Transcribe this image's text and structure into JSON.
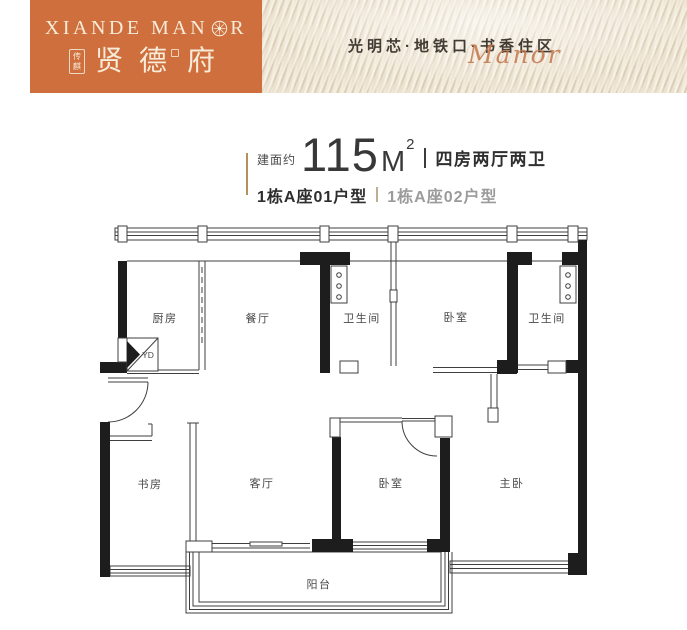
{
  "colors": {
    "brand_orange": "#d06f3e",
    "cream_text": "#f6ecd9",
    "gold_accent": "#b5905a",
    "silk_base": "#e7dcc7",
    "text_dark": "#383838",
    "text_gray": "#9b9b9b",
    "wall_black": "#1d1d1d",
    "script_orange": "#c4764b"
  },
  "header": {
    "logo": {
      "en_part1": "XIANDE MAN",
      "en_part2": "R",
      "en_full": "XIANDE MANOR",
      "seal_char_top": "传",
      "seal_char_bottom": "麒",
      "cn_chars": [
        "贤",
        "德",
        "府"
      ]
    },
    "tagline": "光明芯·地铁口·书香住区",
    "script_word": "Manor"
  },
  "title": {
    "area_label": "建面约",
    "area_value": "115",
    "area_unit": "M",
    "area_exponent": "2",
    "layout_text": "四房两厅两卫",
    "unit_primary": "1栋A座01户型",
    "unit_secondary": "1栋A座02户型"
  },
  "floorplan": {
    "flue_label": "YD",
    "rooms": [
      {
        "id": "kitchen",
        "label": "厨房"
      },
      {
        "id": "dining",
        "label": "餐厅"
      },
      {
        "id": "bath-1",
        "label": "卫生间"
      },
      {
        "id": "bedroom-1",
        "label": "卧室"
      },
      {
        "id": "bath-2",
        "label": "卫生间"
      },
      {
        "id": "study",
        "label": "书房"
      },
      {
        "id": "living",
        "label": "客厅"
      },
      {
        "id": "bedroom-2",
        "label": "卧室"
      },
      {
        "id": "master-bedroom",
        "label": "主卧"
      },
      {
        "id": "balcony",
        "label": "阳台"
      }
    ]
  }
}
